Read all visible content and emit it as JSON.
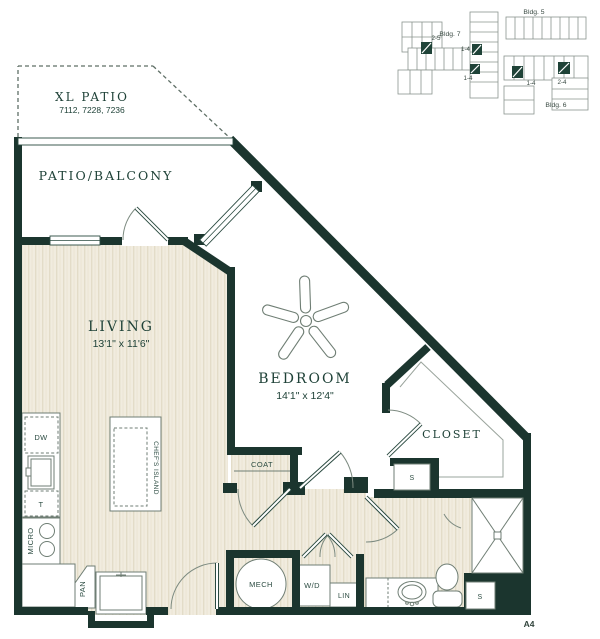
{
  "plan": {
    "sheet_label": "A4",
    "rooms": {
      "xl_patio": {
        "name": "XL PATIO",
        "units": "7112, 7228, 7236"
      },
      "patio": {
        "name": "PATIO/BALCONY"
      },
      "living": {
        "name": "LIVING",
        "dims": "13'1\" x 11'6\""
      },
      "bedroom": {
        "name": "BEDROOM",
        "dims": "14'1\" x 12'4\""
      },
      "closet": {
        "name": "CLOSET"
      }
    },
    "fixtures": {
      "dw": "DW",
      "trash": "T",
      "micro": "MICRO",
      "pan": "PAN",
      "island": "CHEF'S ISLAND",
      "coat": "COAT",
      "mech": "MECH",
      "wd": "W/D",
      "lin": "LIN",
      "shelf_hall": "S",
      "shelf_bath": "S"
    },
    "key_map": {
      "bldg7": {
        "label": "Bldg. 7",
        "units": [
          "2-5",
          "1-4",
          "1-4"
        ]
      },
      "bldg5": {
        "label": "Bldg. 5"
      },
      "bldg6": {
        "label": "Bldg. 6",
        "units": [
          "1-4",
          "2-4"
        ]
      }
    },
    "colors": {
      "wall": "#1b352e",
      "floor": "#f1ecdf",
      "floor_stripe": "#e3dcc8",
      "fixture_line": "#6f7e74",
      "key_line": "#8a948e"
    }
  }
}
